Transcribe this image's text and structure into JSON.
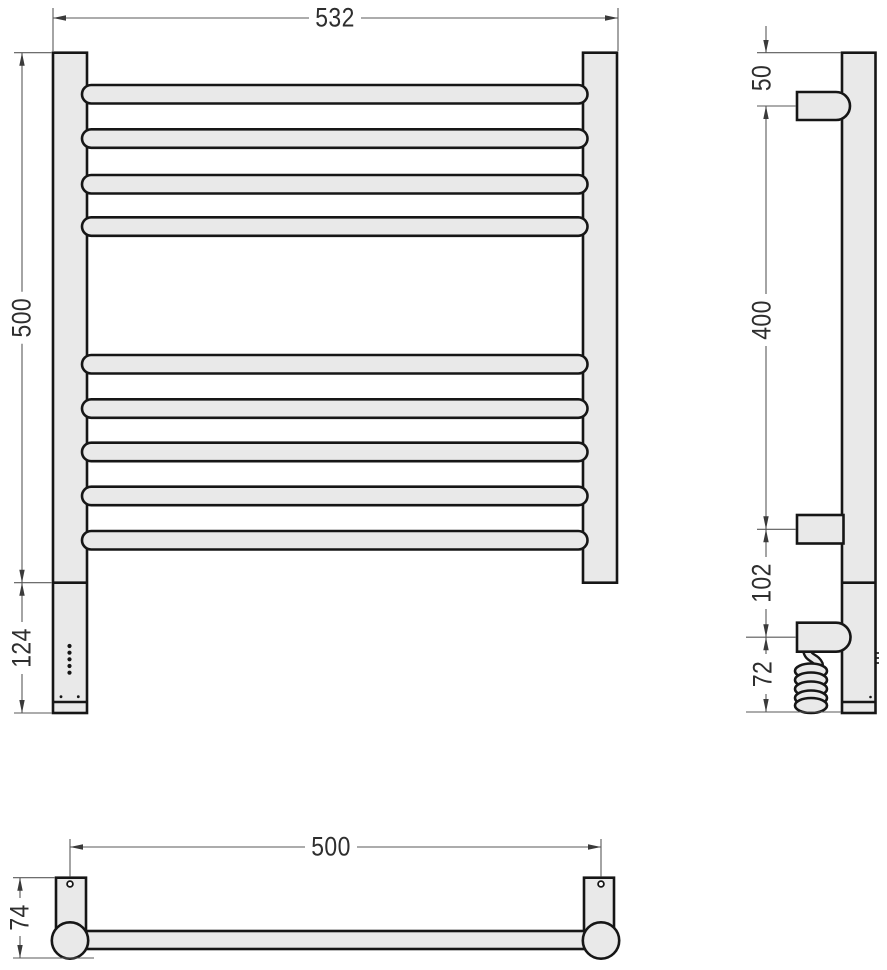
{
  "drawing": {
    "type": "technical-dimension-drawing",
    "colors": {
      "background": "#ffffff",
      "part_fill": "#e9e9e9",
      "part_outline": "#161616",
      "dimension_line": "#595959",
      "dimension_text": "#2e2e2e"
    },
    "front_view": {
      "rungs_top_group": 4,
      "rungs_bottom_group": 5,
      "dims": {
        "overall_width": "532",
        "rail_height": "500",
        "heater_section_height": "124"
      }
    },
    "side_view": {
      "dims": {
        "top_to_upper_bracket": "50",
        "bracket_spacing": "400",
        "bracket_to_element": "102",
        "element_to_bottom": "72"
      }
    },
    "top_view": {
      "dims": {
        "mount_spacing": "500",
        "depth": "74"
      }
    }
  }
}
